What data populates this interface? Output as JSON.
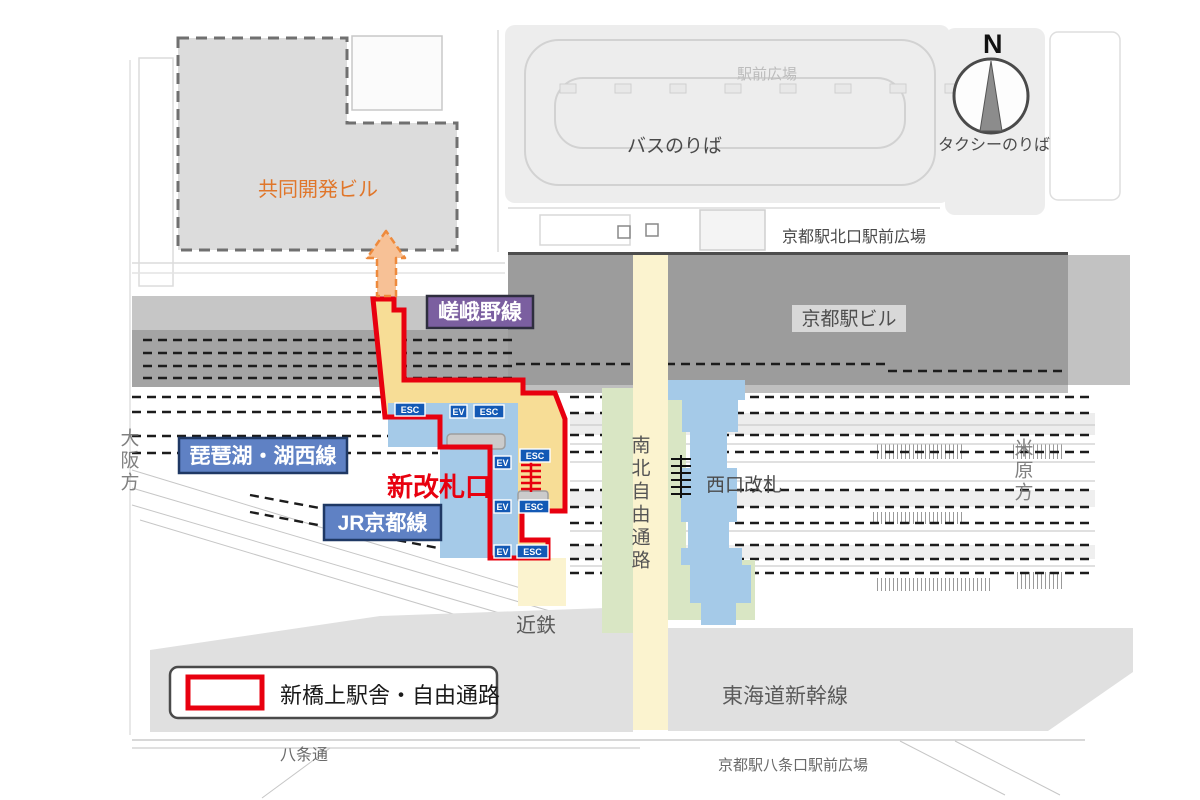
{
  "labels": {
    "kyodo_building": "共同開発ビル",
    "bus_boarding": "バスのりば",
    "station_front_plaza": "駅前広場",
    "taxi_boarding": "タクシーのりば",
    "compass_north": "N",
    "north_exit_plaza": "京都駅北口駅前広場",
    "kyoto_station_building": "京都駅ビル",
    "sagano_line": "嵯峨野線",
    "biwako_kosei_line": "琵琶湖・湖西線",
    "new_ticket_gate": "新改札口",
    "jr_kyoto_line": "JR京都線",
    "north_south_corridor": "南北自由通路",
    "west_ticket_gate": "西口改札",
    "osaka_direction": "大阪方",
    "maibara_direction": "米原方",
    "kintetsu": "近鉄",
    "tokaido_shinkansen": "東海道新幹線",
    "hachijo_street": "八条通",
    "hachijo_exit_plaza": "京都駅八条口駅前広場",
    "esc": "ESC",
    "ev": "EV"
  },
  "legend": {
    "new_station_label": "新橋上駅舎・自由通路"
  },
  "colors": {
    "new_structure_outline": "#e8000f",
    "new_corridor_fill": "#f7dd96",
    "existing_concourse_fill": "#a5cae8",
    "north_south_corridor_fill": "#fbf3cf",
    "plaza_green": "#d9e6c4",
    "sagano_badge_bg": "#7b5fa0",
    "jr_line_badge_bg": "#5f81c4",
    "esc_ev_badge_bg": "#1359b5",
    "arrow_orange": "#ee8a3c",
    "station_building_gray": "#9c9c9c",
    "dev_building_label_orange": "#e0762a"
  }
}
